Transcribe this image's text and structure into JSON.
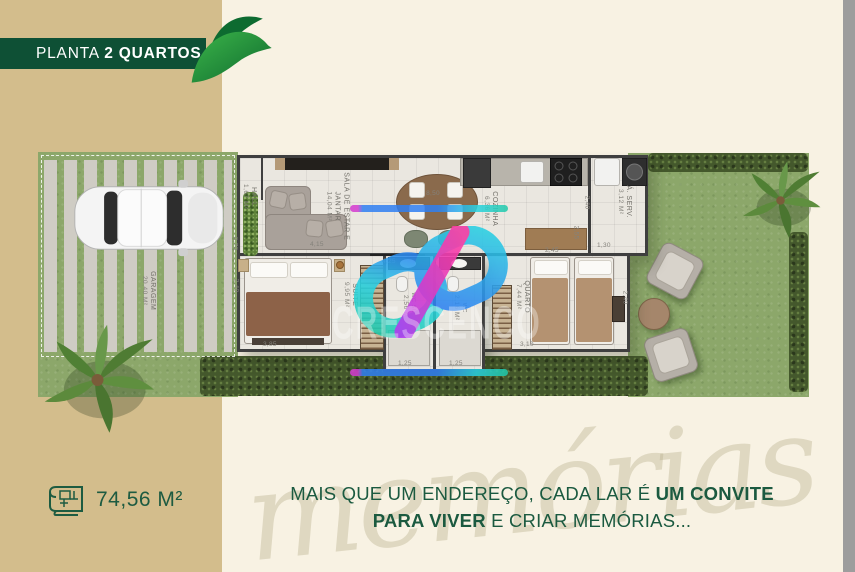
{
  "banner": {
    "title_regular": "PLANTA ",
    "title_bold": "2 QUARTOS"
  },
  "area_badge": {
    "value": "74,56 M²"
  },
  "slogan": {
    "l1a": "MAIS QUE UM ENDEREÇO, CADA LAR É ",
    "l1b": "UM CONVITE",
    "l2a": "PARA VIVER",
    "l2b": " E CRIAR MEMÓRIAS..."
  },
  "watermark": {
    "brand": "CRESCENCO",
    "script": "memórias"
  },
  "floorplan": {
    "rooms": {
      "hall": {
        "label": "HALL",
        "area": "1,67 m²"
      },
      "sala": {
        "label": "SALA DE ESTAR E JANTAR",
        "area": "14,04 m²"
      },
      "cozinha": {
        "label": "COZINHA",
        "area": "6,36 m²"
      },
      "serv": {
        "label": "Á. SERV.",
        "area": "3,12 m²"
      },
      "suite": {
        "label": "SUITE",
        "area": "9,95 m²"
      },
      "wc_suite": {
        "label": "WC SUITE",
        "area": "2,56 m²"
      },
      "wc": {
        "label": "WC",
        "area": "2,16 m²"
      },
      "quarto": {
        "label": "QUARTO",
        "area": "7,44 m²"
      },
      "garagem": {
        "label": "GARAGEM",
        "area": "20,40 m²"
      }
    },
    "dims": {
      "top": "8,50",
      "sala_width": "4,15",
      "sala_left": "0,70",
      "suite_left": "2,40",
      "suite_bottom": "3,85",
      "corridor": "4,25",
      "cozinha_right": "2,55",
      "serv_left": "2,40",
      "serv_bottom": "1,30",
      "quarto_top": "2,45",
      "quarto_right": "2,40",
      "quarto_bottom": "3,10",
      "wc1_bottom": "1,25",
      "wc2_bottom": "1,25"
    }
  },
  "colors": {
    "banner_green": "#0e5035",
    "text_green": "#1d5b41",
    "tan": "#d3bd8c",
    "cream": "#f8f2e3",
    "edge_gray": "#9d9d9d",
    "logo_cyan": "#29d3e2",
    "logo_blue": "#2f7ff2",
    "logo_magenta": "#e03bc0",
    "logo_pink": "#ff3fa4"
  }
}
